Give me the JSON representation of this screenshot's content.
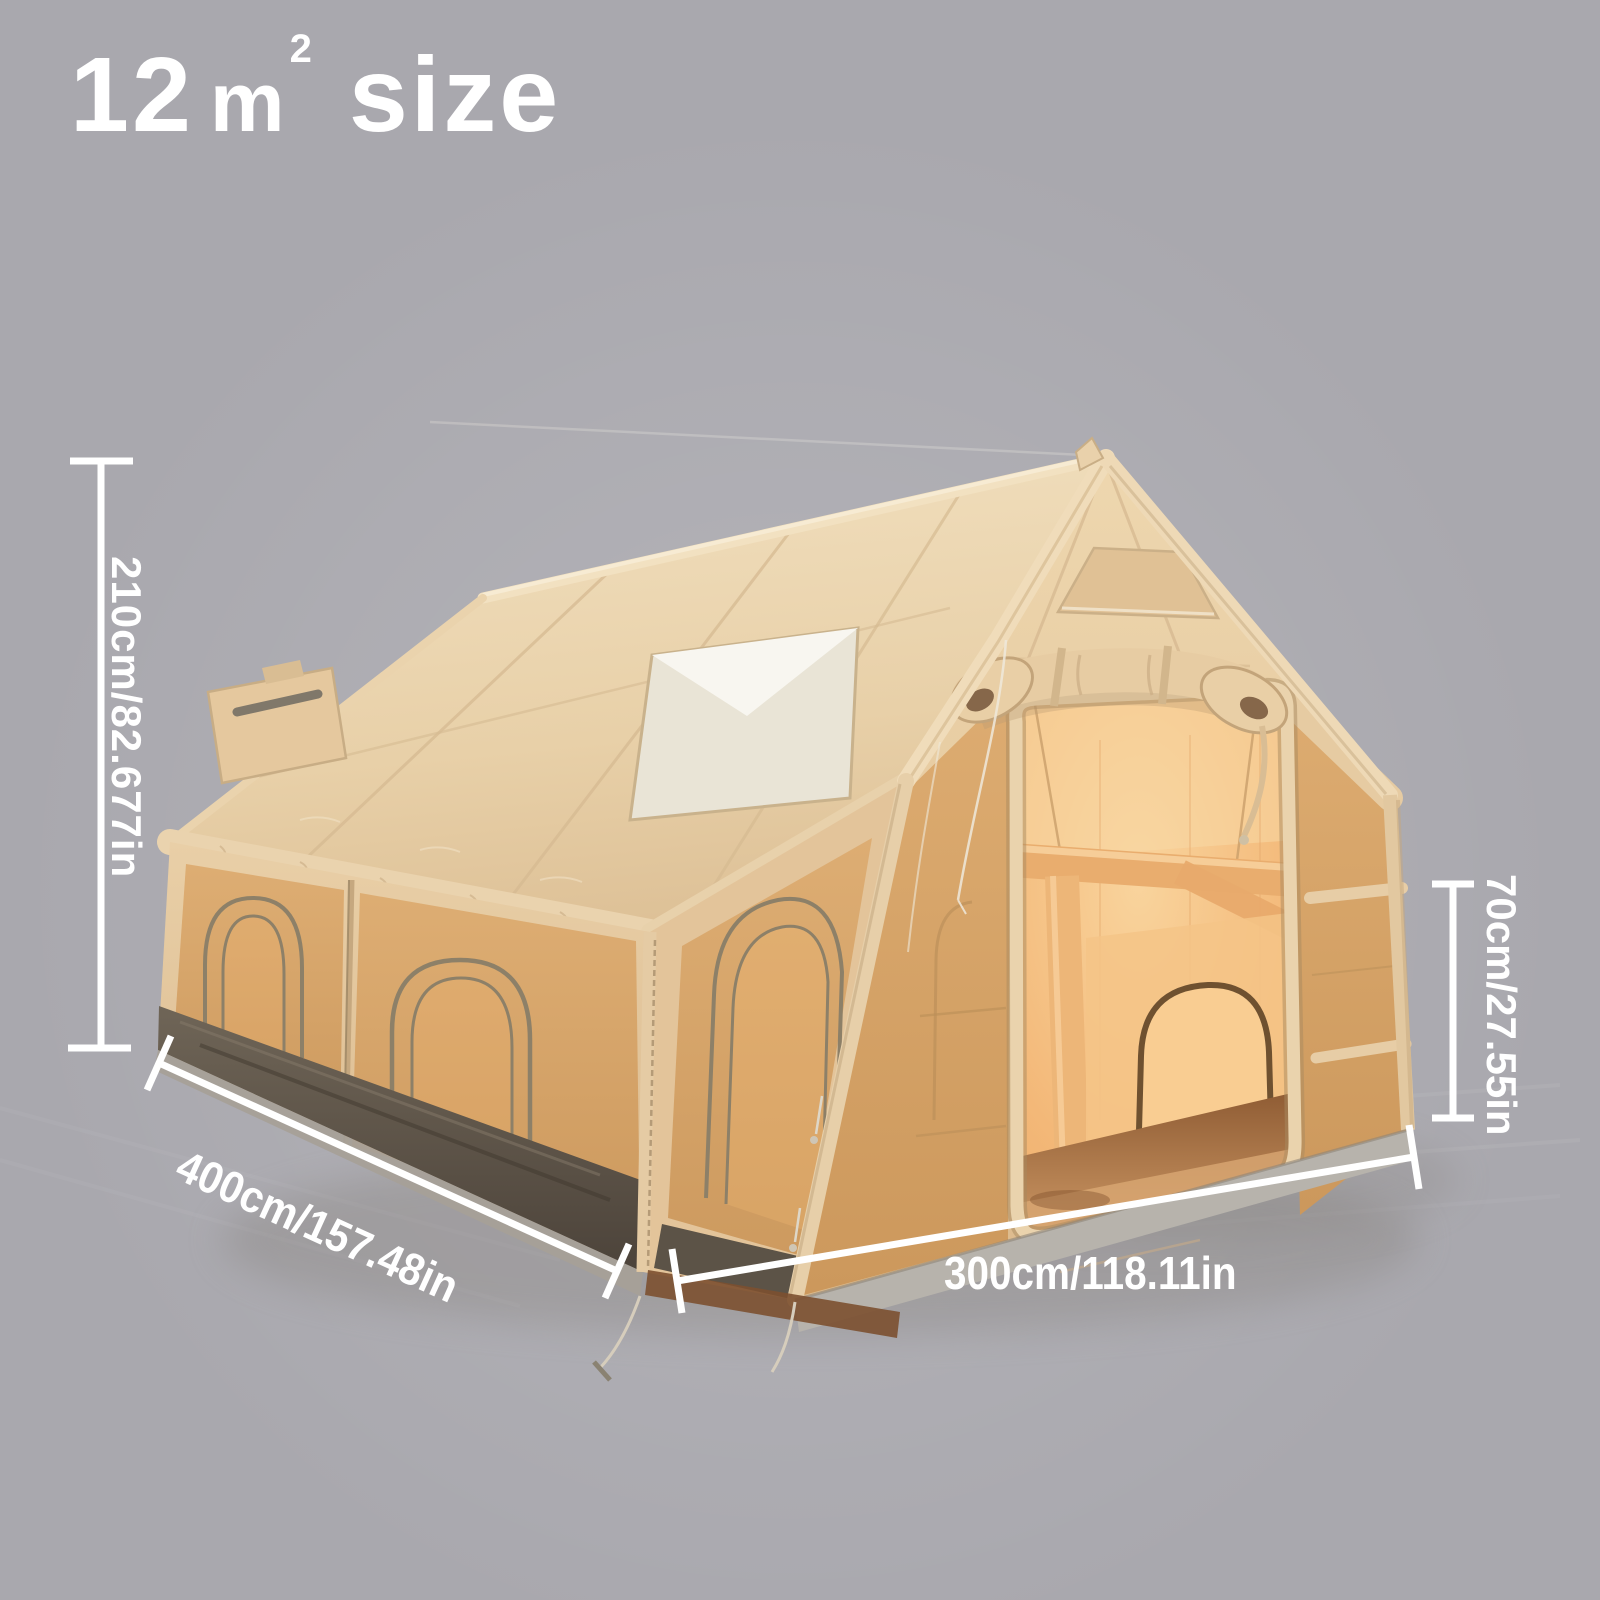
{
  "title": {
    "number": "12",
    "unit_base": "m",
    "unit_exponent": "2",
    "word": "size"
  },
  "dimensions": {
    "height": {
      "label": "210cm/82.677in"
    },
    "width": {
      "label": "400cm/157.48in"
    },
    "depth": {
      "label": "300cm/118.11in"
    },
    "door_height": {
      "label": "70cm/27.55in"
    }
  },
  "colors": {
    "background": "#a9a8ae",
    "annotation": "#ffffff",
    "tent_fabric": "#e9d2ac",
    "tent_fabric_dark": "#dfc199",
    "mesh_window": "#d5a368",
    "interior_glow": "#f3b878",
    "floor_brown": "#9a6437",
    "skirt_gray": "#b7b3ac",
    "base_band_dark": "#5c5347"
  },
  "images": {
    "tent": "inflatable-cabin-tent-photo"
  }
}
